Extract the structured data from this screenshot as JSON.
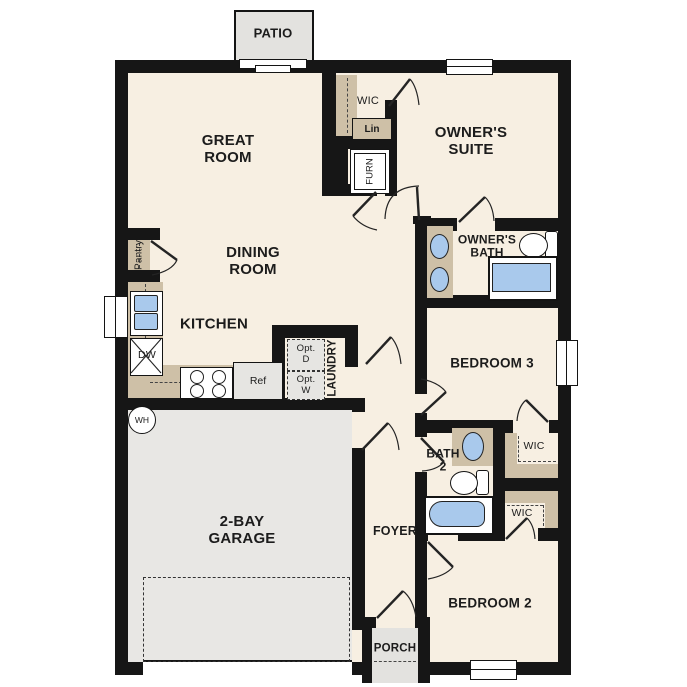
{
  "plan": {
    "title": "single-story floor plan",
    "rooms": {
      "patio": "PATIO",
      "great_room": "GREAT\nROOM",
      "owner_suite": "OWNER'S\nSUITE",
      "owner_wic": "WIC",
      "linen": "Lin",
      "dining": "DINING\nROOM",
      "owner_bath": "OWNER'S\nBATH",
      "pantry": "Pantry",
      "kitchen": "KITCHEN",
      "laundry": "LAUNDRY",
      "bedroom3": "BEDROOM 3",
      "bath2": "BATH\n2",
      "wic_bed3": "WIC",
      "wic_bed2": "WIC",
      "garage": "2-BAY\nGARAGE",
      "foyer": "FOYER",
      "porch": "PORCH",
      "bedroom2": "BEDROOM 2"
    },
    "fixtures": {
      "furnace": "FURN",
      "dishwasher": "DW",
      "refrigerator": "Ref",
      "water_heater": "WH",
      "opt_dryer": "Opt.\nD",
      "opt_washer": "Opt.\nW"
    },
    "colors": {
      "wall": "#161616",
      "floor": "#f7efe2",
      "cabinet_tan": "#cec0a7",
      "garage_gray": "#e8e7e4",
      "patio_gray": "#e3e2df",
      "fixture_blue": "#a9c9ec",
      "appliance_gray": "#e6e5e2"
    }
  }
}
